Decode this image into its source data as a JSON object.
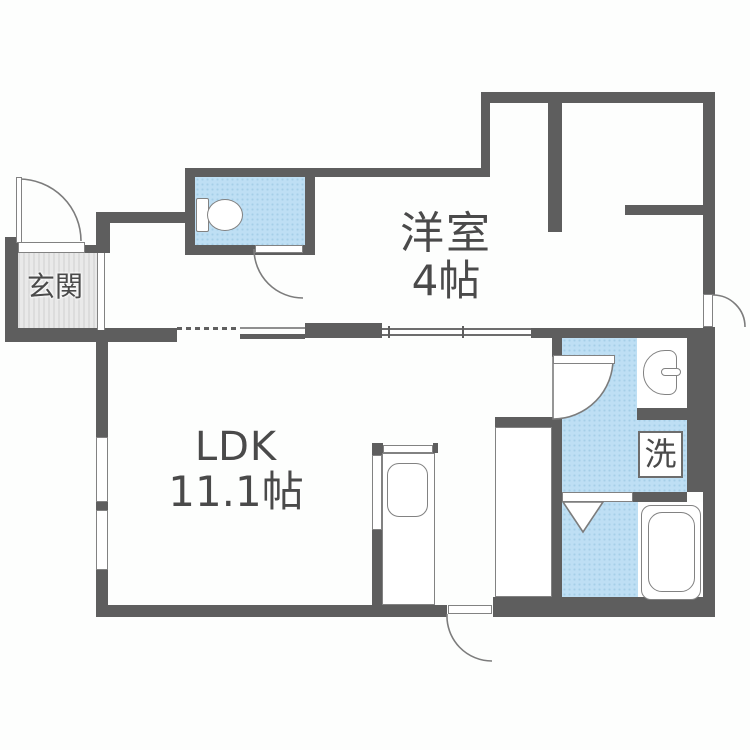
{
  "plan": {
    "type": "japanese-apartment-floorplan",
    "rooms": {
      "genkan": {
        "label": "玄関"
      },
      "western_room": {
        "name": "洋室",
        "size": "4帖"
      },
      "ldk": {
        "name": "LDK",
        "size": "11.1帖"
      },
      "laundry": {
        "label": "洗"
      }
    },
    "fixtures": [
      "toilet",
      "washbasin",
      "washing-machine-pan",
      "bathtub",
      "kitchen-sink"
    ],
    "colors": {
      "wall": "#5e5e5e",
      "water_area": "#bedff4",
      "water_area_dot": "#a5cfe7",
      "genkan_floor": "#e3e3e3",
      "label_text": "#4a4a4a"
    }
  }
}
